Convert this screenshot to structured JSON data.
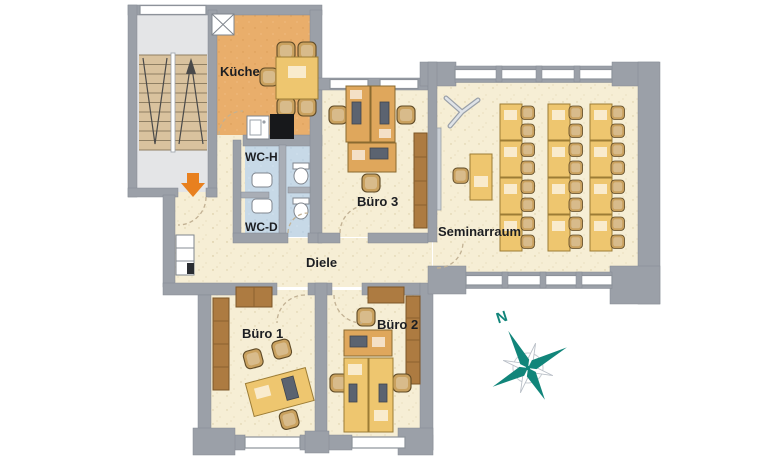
{
  "page": {
    "type": "architectural-floor-plan",
    "floor_shown": "office level"
  },
  "colors": {
    "wall": "#9ba0a8",
    "floor_cream": "#f6eed5",
    "floor_kitchen": "#e9ae6b",
    "floor_wc": "#c7d9e7",
    "floor_stairs": "#e4e5e7",
    "step_tan": "#d9c29e",
    "desk_orange": "#dfa75c",
    "desk_yellow": "#eec66f",
    "chair_tan": "#c9a15f",
    "cabinet_brown": "#ad7b41",
    "compass_teal": "#11857a",
    "entrance_orange": "#e8801f"
  },
  "rooms": {
    "kueche": {
      "label": "Küche"
    },
    "wc_h": {
      "label": "WC-H"
    },
    "wc_d": {
      "label": "WC-D"
    },
    "buero3": {
      "label": "Büro 3"
    },
    "seminarraum": {
      "label": "Seminarraum"
    },
    "diele": {
      "label": "Diele"
    },
    "buero1": {
      "label": "Büro 1"
    },
    "buero2": {
      "label": "Büro 2"
    }
  },
  "compass": {
    "north_label": "N"
  },
  "icons": {
    "compass": "compass-rose",
    "entrance": "orange-arrow-down",
    "stairs": "double-flight-staircase",
    "flipchart": "easel",
    "shaft": "crossed-box"
  }
}
